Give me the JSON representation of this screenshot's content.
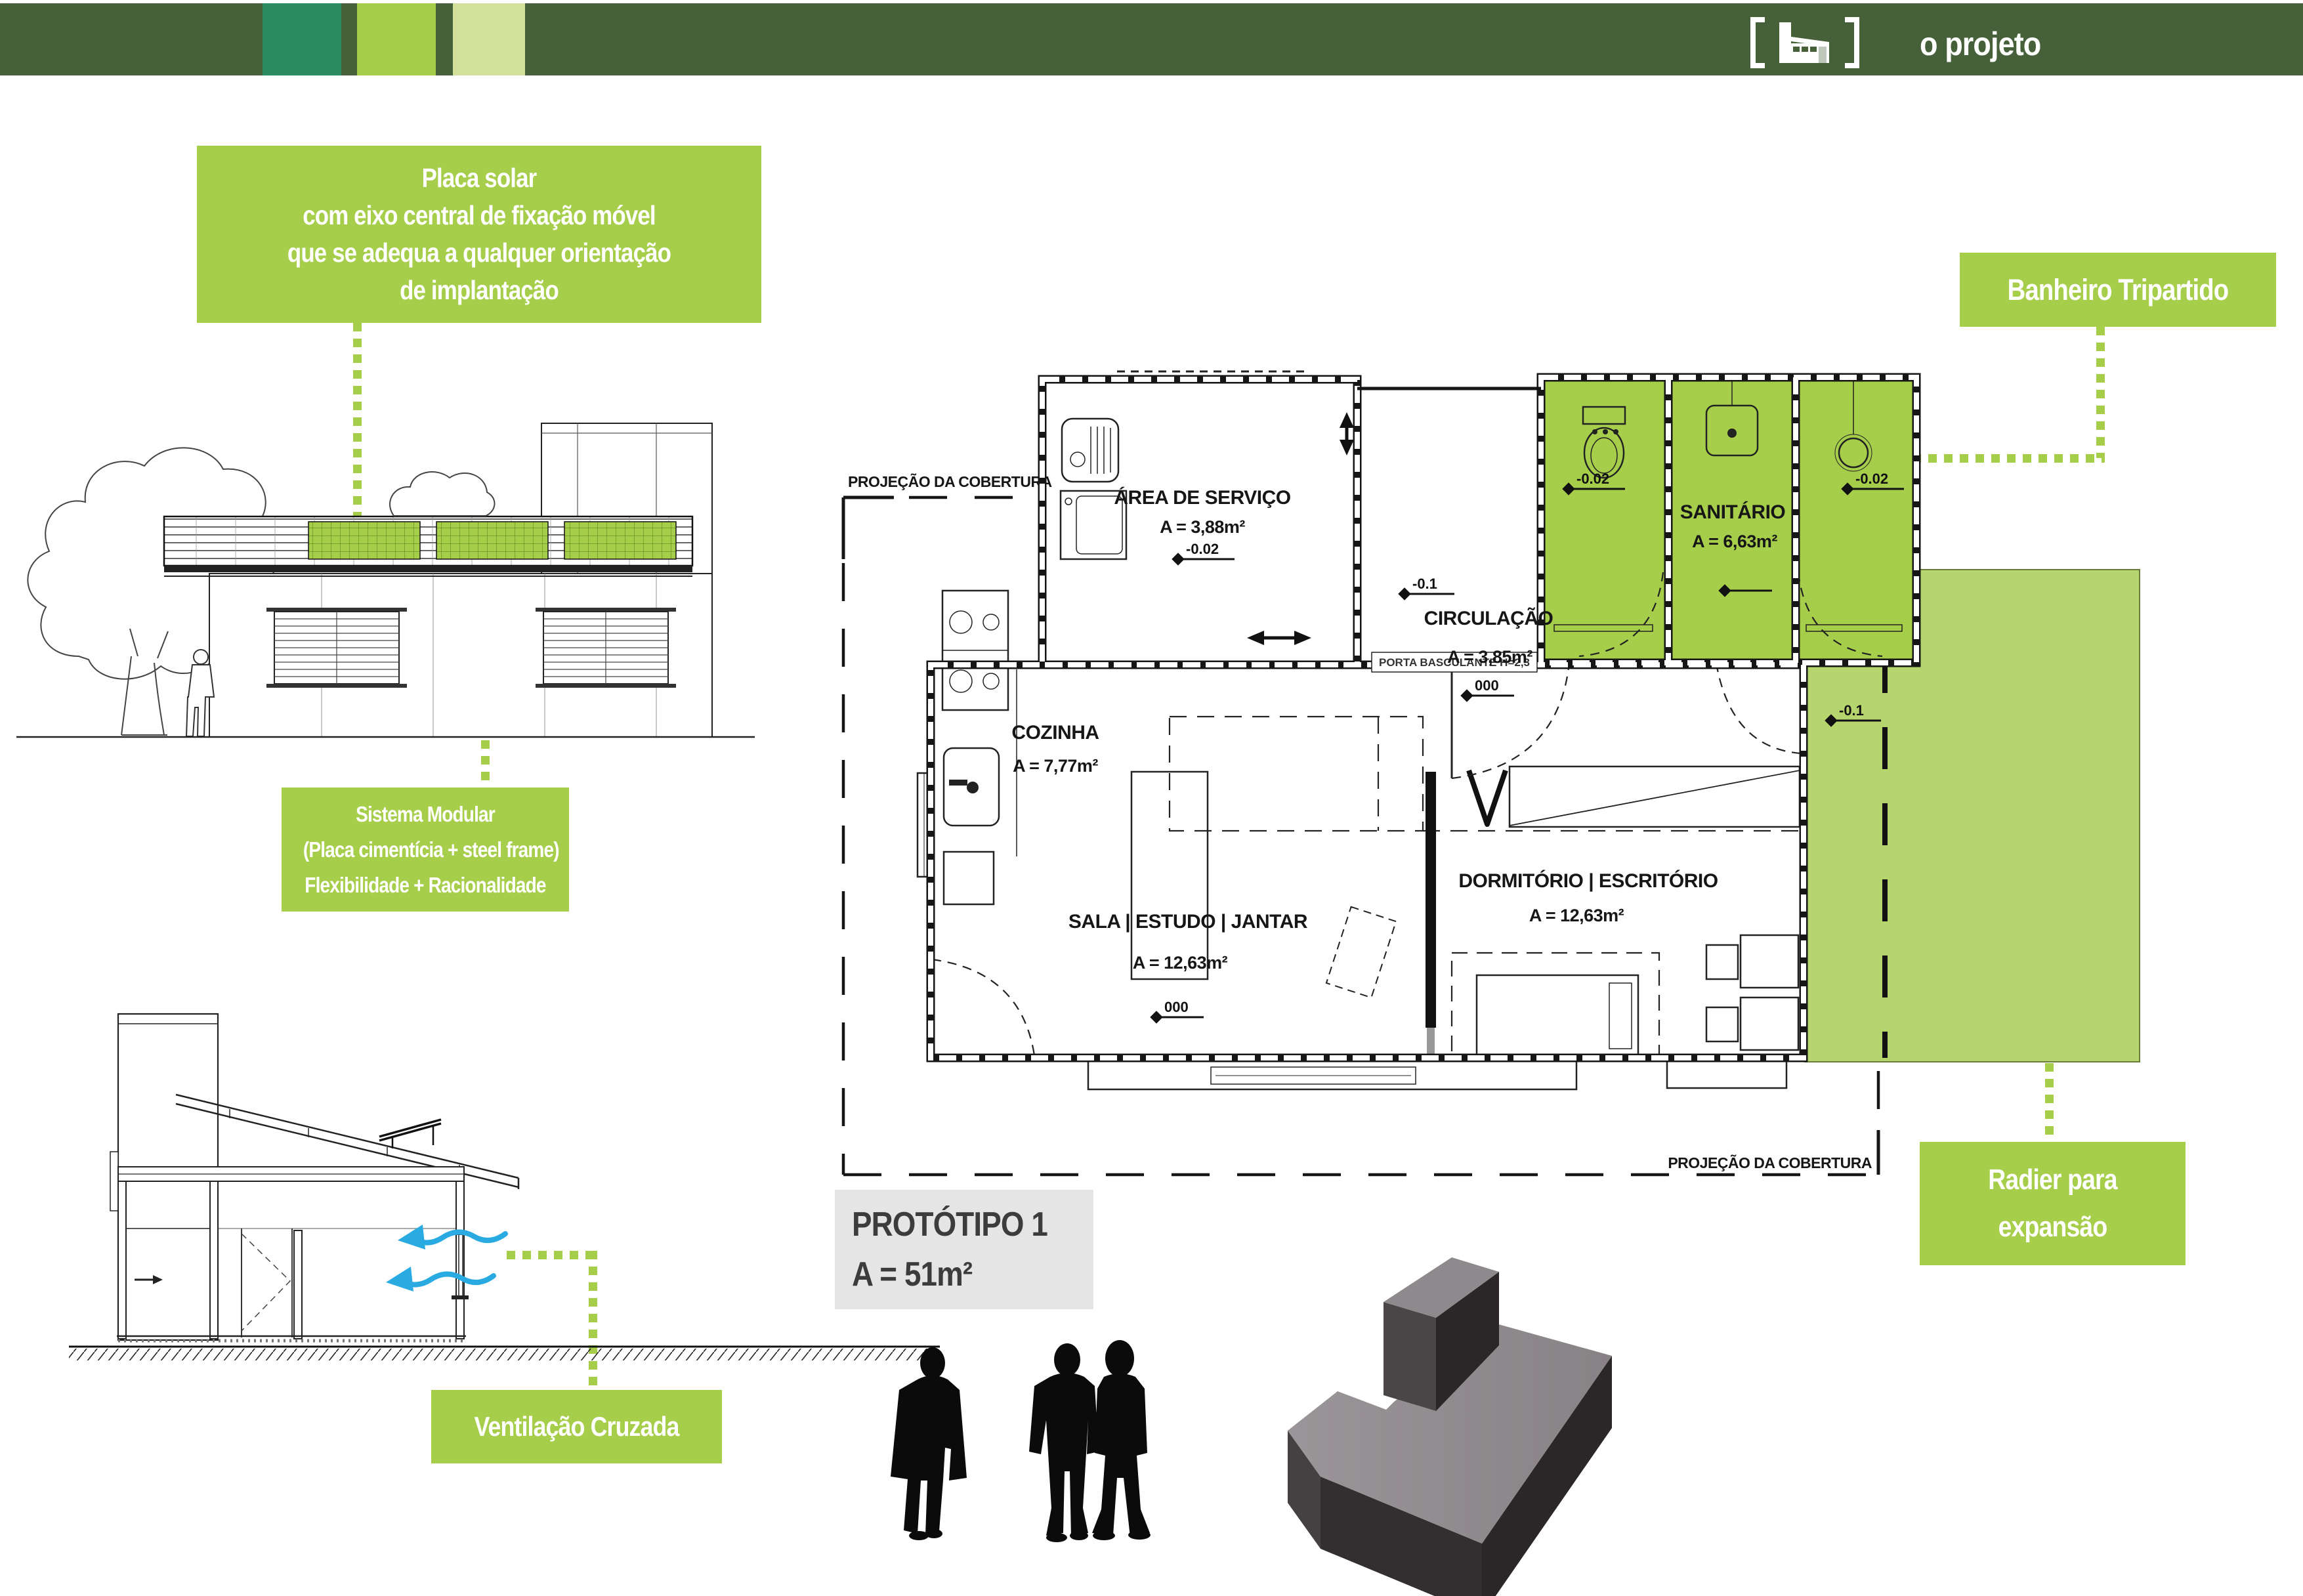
{
  "header": {
    "title": "o projeto",
    "bar_color": "#46613A",
    "swatch_colors": [
      "#2A8C5F",
      "#A6CE4B",
      "#D3E09A"
    ],
    "logo_icon": "house-in-brackets-icon"
  },
  "callouts": {
    "placa_solar": {
      "lines": [
        "Placa solar",
        "com eixo central de fixação móvel",
        "que se adequa a qualquer orientação",
        "de implantação"
      ]
    },
    "banheiro_tripartido": {
      "label": "Banheiro Tripartido"
    },
    "sistema_modular": {
      "lines": [
        "Sistema Modular",
        "(Placa cimentícia + steel frame)",
        "Flexibilidade + Racionalidade"
      ]
    },
    "radier": {
      "lines": [
        "Radier para",
        "expansão"
      ]
    },
    "ventilacao": {
      "label": "Ventilação Cruzada"
    }
  },
  "prototype": {
    "title": "PROTÓTIPO 1",
    "area": "A = 51m²"
  },
  "plan": {
    "rooms": {
      "area_servico": {
        "name": "ÁREA DE SERVIÇO",
        "area": "A = 3,88m²"
      },
      "sanitario": {
        "name": "SANITÁRIO",
        "area": "A = 6,63m²"
      },
      "circulacao": {
        "name": "CIRCULAÇÃO",
        "area": "A = 3,85m²"
      },
      "cozinha": {
        "name": "COZINHA",
        "area": "A = 7,77m²"
      },
      "dormitorio": {
        "name": "DORMITÓRIO | ESCRITÓRIO",
        "area": "A = 12,63m²"
      },
      "sala": {
        "name": "SALA | ESTUDO | JANTAR",
        "area": "A = 12,63m²"
      }
    },
    "levels": {
      "servico": "-0.02",
      "porch": "-0.1",
      "san_left": "-0.02",
      "san_right": "-0.02",
      "san_mid": "000",
      "circulacao": "000",
      "sala": "000",
      "expansao": "-0.1"
    },
    "notes": {
      "roof_projection_top": "PROJEÇÃO DA COBERTURA",
      "roof_projection_bottom": "PROJEÇÃO DA COBERTURA",
      "door_note": "PORTA BASCULANTE H=2,3"
    }
  },
  "colors": {
    "accent_lime": "#A6CE4B",
    "expansion_fill": "#B7D56E",
    "wind_arrow_blue": "#29ABE2",
    "prototype_box": "#E5E5E5",
    "massing_gray": "#8F8A8D",
    "massing_dark": "#332F30"
  }
}
